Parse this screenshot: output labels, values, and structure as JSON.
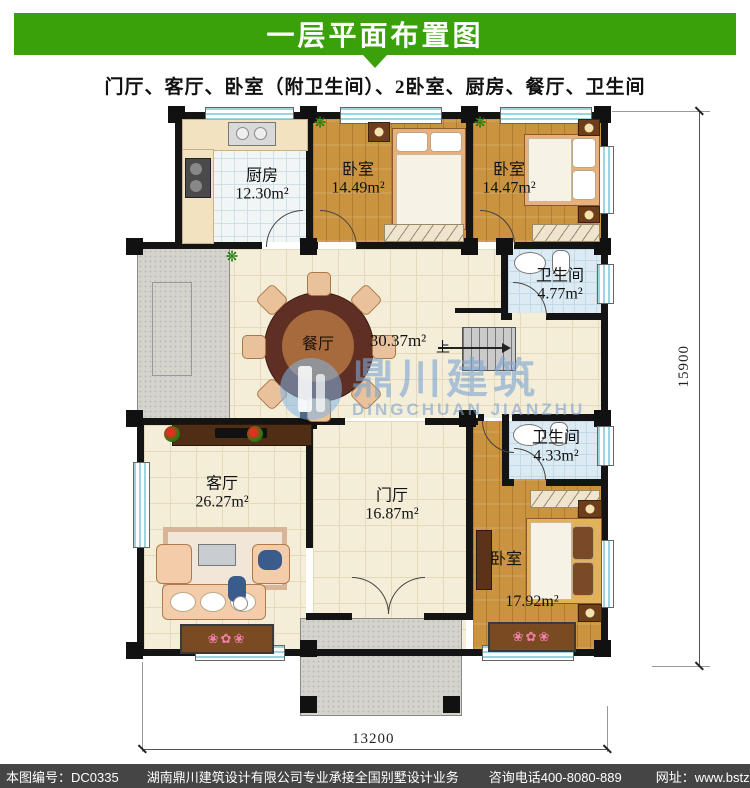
{
  "header": {
    "title": "一层平面布置图"
  },
  "subtitle": "门厅、客厅、卧室（附卫生间）、2卧室、厨房、餐厅、卫生间",
  "rooms": {
    "kitchen": {
      "name": "厨房",
      "area": "12.30m²"
    },
    "bedroom_top_mid": {
      "name": "卧室",
      "area": "14.49m²"
    },
    "bedroom_top_right": {
      "name": "卧室",
      "area": "14.47m²"
    },
    "bath_upper": {
      "name": "卫生间",
      "area": "4.77m²"
    },
    "dining": {
      "name": "餐厅",
      "area": "30.37m²"
    },
    "living": {
      "name": "客厅",
      "area": "26.27m²"
    },
    "foyer": {
      "name": "门厅",
      "area": "16.87m²"
    },
    "bath_lower": {
      "name": "卫生间",
      "area": "4.33m²"
    },
    "bedroom_bottom": {
      "name": "卧室",
      "area": "17.92m²"
    }
  },
  "stairs": {
    "up_label": "上"
  },
  "watermark": {
    "name_cn": "鼎川建筑",
    "name_en": "DINGCHUAN JIANZHU"
  },
  "dimensions": {
    "height_label": "15900",
    "width_label": "13200"
  },
  "footer": {
    "plan_no": "本图编号：DC0335",
    "company": "湖南鼎川建筑设计有限公司专业承接全国别墅设计业务",
    "phone": "咨询电话400-8080-889",
    "website": "网址：www.bstzcs.com"
  },
  "colors": {
    "banner_green": "#3BA10B",
    "footer_gray": "#454545",
    "wall_black": "#141414",
    "watermark_blue": "#7DA5D2"
  }
}
